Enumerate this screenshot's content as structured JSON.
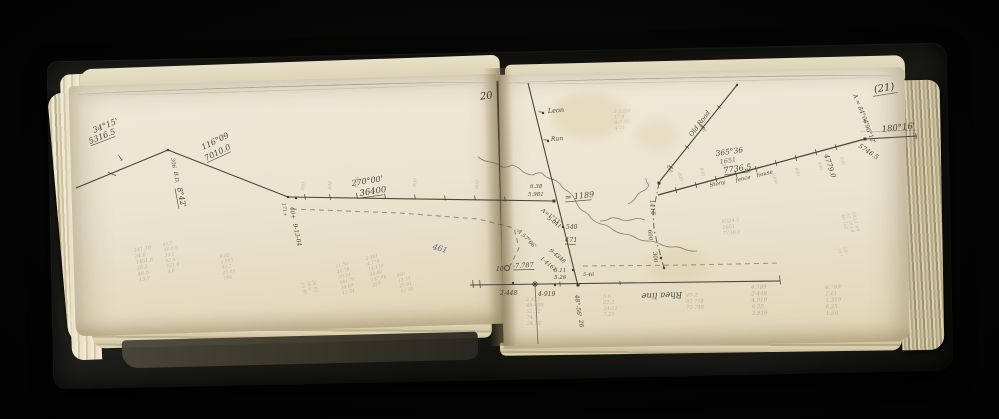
{
  "palette": {
    "background": "#050505",
    "cover": "#191a16",
    "page": "#ece4cf",
    "ink": "#3b3a33",
    "pencil": "#8d8570",
    "blue_ink": "#44517a"
  },
  "page_numbers": {
    "left": "20",
    "right": "(21)"
  },
  "diagram": {
    "lines": [
      [
        76,
        188,
        168,
        150
      ],
      [
        168,
        150,
        288,
        197
      ],
      [
        288,
        197,
        554,
        201
      ],
      [
        528,
        83,
        578,
        286
      ],
      [
        470,
        285,
        780,
        281
      ],
      [
        535,
        284,
        538,
        344,
        0.8,
        0.7
      ],
      [
        658,
        195,
        865,
        139,
        1.3
      ],
      [
        865,
        139,
        917,
        136
      ],
      [
        860,
        132,
        917,
        130,
        0.6,
        0.35
      ],
      [
        660,
        181,
        737,
        85
      ]
    ],
    "dashed": [
      {
        "pts": [
          [
            292,
            209
          ],
          [
            400,
            213
          ],
          [
            478,
            219
          ],
          [
            514,
            228
          ],
          [
            519,
            248
          ],
          [
            510,
            266
          ]
        ],
        "dash": "5 4",
        "o": 0.55
      },
      {
        "pts": [
          [
            583,
            266
          ],
          [
            690,
            265
          ],
          [
            780,
            263
          ]
        ],
        "dash": "5 4",
        "o": 0.5
      },
      {
        "pts": [
          [
            659,
            183
          ],
          [
            656,
            198
          ],
          [
            653,
            212
          ],
          [
            654,
            228
          ],
          [
            657,
            243
          ],
          [
            661,
            257
          ],
          [
            664,
            268
          ]
        ],
        "dash": "6 3 1.5 3",
        "o": 0.8
      }
    ],
    "streams": [
      {
        "pts": [
          [
            478,
            157
          ],
          [
            490,
            162
          ],
          [
            502,
            167
          ],
          [
            512,
            165
          ],
          [
            522,
            171
          ],
          [
            533,
            175
          ],
          [
            542,
            173
          ],
          [
            551,
            179
          ],
          [
            560,
            184
          ],
          [
            569,
            192
          ],
          [
            576,
            202
          ],
          [
            583,
            211
          ],
          [
            591,
            218
          ],
          [
            601,
            224
          ],
          [
            612,
            229
          ],
          [
            624,
            234
          ],
          [
            636,
            238
          ],
          [
            648,
            241
          ],
          [
            660,
            244
          ],
          [
            672,
            247
          ],
          [
            684,
            249
          ],
          [
            697,
            251
          ]
        ]
      },
      {
        "pts": [
          [
            600,
            221
          ],
          [
            611,
            218
          ],
          [
            622,
            220
          ],
          [
            634,
            219
          ],
          [
            645,
            220
          ]
        ]
      },
      {
        "pts": [
          [
            628,
            204
          ],
          [
            636,
            197
          ],
          [
            643,
            191
          ],
          [
            649,
            185
          ],
          [
            646,
            178
          ]
        ]
      }
    ],
    "points": [
      [
        168,
        150
      ],
      [
        288,
        197
      ],
      [
        296,
        198
      ],
      [
        554,
        201,
        3
      ],
      [
        563,
        227
      ],
      [
        573,
        270
      ],
      [
        578,
        285,
        3
      ],
      [
        513,
        283
      ],
      [
        535,
        284
      ],
      [
        555,
        285
      ],
      [
        659,
        183,
        3
      ],
      [
        661,
        258
      ],
      [
        664,
        268
      ],
      [
        865,
        139,
        3
      ],
      [
        737,
        85
      ],
      [
        543,
        113
      ],
      [
        548,
        141
      ]
    ],
    "circles": [
      [
        507,
        268,
        2.5
      ],
      [
        535,
        284,
        2.2
      ]
    ],
    "ticks": [
      [
        112,
        174,
        25,
        9
      ],
      [
        305,
        197,
        80,
        6
      ],
      [
        330,
        197,
        80,
        6
      ],
      [
        357,
        196,
        80,
        6
      ],
      [
        385,
        196,
        80,
        5
      ],
      [
        415,
        197,
        80,
        5
      ],
      [
        445,
        198,
        80,
        5
      ],
      [
        475,
        198,
        80,
        5
      ],
      [
        505,
        199,
        80,
        5
      ],
      [
        541,
        112,
        5,
        5
      ],
      [
        546,
        140,
        5,
        5
      ],
      [
        473,
        284,
        85,
        8
      ],
      [
        480,
        284,
        85,
        8
      ],
      [
        780,
        280,
        85,
        9
      ],
      [
        560,
        284,
        85,
        5
      ],
      [
        620,
        283,
        85,
        4
      ],
      [
        676,
        190,
        75,
        6
      ],
      [
        696,
        185,
        75,
        6
      ],
      [
        716,
        179,
        75,
        6
      ],
      [
        736,
        174,
        75,
        6
      ],
      [
        756,
        169,
        75,
        6
      ],
      [
        776,
        163,
        75,
        6
      ],
      [
        796,
        158,
        75,
        6
      ],
      [
        816,
        152,
        75,
        6
      ],
      [
        836,
        147,
        75,
        6
      ],
      [
        671,
        167,
        35,
        5
      ],
      [
        687,
        147,
        35,
        5
      ],
      [
        703,
        127,
        35,
        5
      ],
      [
        719,
        107,
        35,
        5
      ],
      [
        916,
        136,
        85,
        6
      ]
    ],
    "labels": [
      {
        "t": "34°15'",
        "x": 94,
        "y": 133,
        "r": -22,
        "s": 8
      },
      {
        "t": "5316.5",
        "x": 90,
        "y": 144,
        "r": -22,
        "s": 8,
        "u": 1
      },
      {
        "t": "↘",
        "x": 116,
        "y": 160,
        "r": 10,
        "s": 9,
        "o": 0.85
      },
      {
        "t": "306",
        "x": 171,
        "y": 158,
        "r": 82,
        "s": 5.5,
        "o": 0.85
      },
      {
        "t": "B.D.",
        "x": 174,
        "y": 172,
        "r": 82,
        "s": 5.5,
        "o": 0.85
      },
      {
        "t": "8°42'",
        "x": 177,
        "y": 188,
        "r": 78,
        "s": 7.5,
        "u": 1
      },
      {
        "t": "116°09",
        "x": 203,
        "y": 150,
        "r": -26,
        "s": 8
      },
      {
        "t": "7010.0",
        "x": 206,
        "y": 161,
        "r": -26,
        "s": 8,
        "u": 1
      },
      {
        "t": "171+",
        "x": 282,
        "y": 203,
        "r": 82,
        "s": 5,
        "o": 0.8
      },
      {
        "t": "40+",
        "x": 290,
        "y": 207,
        "r": 82,
        "s": 6
      },
      {
        "t": "9-13-04",
        "x": 293,
        "y": 224,
        "r": 78,
        "s": 6
      },
      {
        "t": "270°00'",
        "x": 352,
        "y": 186,
        "r": -9,
        "s": 8
      },
      {
        "t": "36400",
        "x": 360,
        "y": 196,
        "r": -9,
        "s": 8.5,
        "u": 1
      },
      {
        "t": "461",
        "x": 432,
        "y": 249,
        "r": 16,
        "s": 8,
        "c": "blue",
        "o": 0.85
      },
      {
        "t": "Leon",
        "x": 548,
        "y": 113,
        "r": -4,
        "s": 6.5
      },
      {
        "t": "Run",
        "x": 551,
        "y": 141,
        "r": -4,
        "s": 6
      },
      {
        "t": "6.38",
        "x": 530,
        "y": 188,
        "r": 0,
        "s": 5.5
      },
      {
        "t": "5.981",
        "x": 528,
        "y": 196,
        "r": 0,
        "s": 5.5
      },
      {
        "t": "= 1189",
        "x": 565,
        "y": 200,
        "r": -6,
        "s": 8,
        "u": 1
      },
      {
        "t": "A=1°11'",
        "x": 541,
        "y": 211,
        "r": 36,
        "s": 5.5
      },
      {
        "t": "5-041'",
        "x": 547,
        "y": 219,
        "r": 36,
        "s": 5.5
      },
      {
        "t": "-A 57°06'",
        "x": 516,
        "y": 230,
        "r": 46,
        "s": 5.5
      },
      {
        "t": "540",
        "x": 566,
        "y": 229,
        "r": 0,
        "s": 6
      },
      {
        "t": "471",
        "x": 565,
        "y": 242,
        "r": 0,
        "s": 6.5,
        "u": 1
      },
      {
        "t": "9-4348",
        "x": 549,
        "y": 251,
        "r": 40,
        "s": 5.5
      },
      {
        "t": "1-4161",
        "x": 540,
        "y": 259,
        "r": 40,
        "s": 5.5
      },
      {
        "t": "6.11",
        "x": 554,
        "y": 272,
        "r": 0,
        "s": 5.5
      },
      {
        "t": "5.26",
        "x": 554,
        "y": 279,
        "r": 0,
        "s": 5.5
      },
      {
        "t": "5-46",
        "x": 583,
        "y": 276,
        "r": 0,
        "s": 5,
        "o": 0.85
      },
      {
        "t": "10",
        "x": 496,
        "y": 271,
        "r": 0,
        "s": 6
      },
      {
        "t": "-7.787",
        "x": 513,
        "y": 268,
        "r": -3,
        "s": 6.5,
        "u": 1
      },
      {
        "t": "2-448",
        "x": 500,
        "y": 295,
        "r": 0,
        "s": 6
      },
      {
        "t": "4-919",
        "x": 538,
        "y": 296,
        "r": 0,
        "s": 6
      },
      {
        "t": "48°-56'",
        "x": 575,
        "y": 295,
        "r": 84,
        "s": 6
      },
      {
        "t": "26",
        "x": 579,
        "y": 320,
        "r": 84,
        "s": 6
      },
      {
        "t": "Rhea line",
        "x": 682,
        "y": 292,
        "r": 178,
        "s": 8.5
      },
      {
        "t": "365°36",
        "x": 716,
        "y": 156,
        "r": -8,
        "s": 7.5
      },
      {
        "t": "1651",
        "x": 720,
        "y": 164,
        "r": -8,
        "s": 6.5,
        "o": 0.7
      },
      {
        "t": "7736.5",
        "x": 724,
        "y": 173,
        "r": -8,
        "s": 8,
        "u": 1
      },
      {
        "t": "Stony",
        "x": 710,
        "y": 187,
        "r": -13,
        "s": 5.5
      },
      {
        "t": "fence",
        "x": 736,
        "y": 182,
        "r": -13,
        "s": 5.5
      },
      {
        "t": "house",
        "x": 757,
        "y": 177,
        "r": -13,
        "s": 5.5
      },
      {
        "t": "4779.0",
        "x": 824,
        "y": 155,
        "r": 72,
        "s": 7
      },
      {
        "t": "Old Road",
        "x": 692,
        "y": 137,
        "r": -53,
        "s": 6.5
      },
      {
        "t": "1416",
        "x": 650,
        "y": 200,
        "r": 84,
        "s": 6
      },
      {
        "t": "600",
        "x": 648,
        "y": 230,
        "r": 84,
        "s": 5.5
      },
      {
        "t": "300",
        "x": 653,
        "y": 252,
        "r": 84,
        "s": 5.5
      },
      {
        "t": "400",
        "x": 666,
        "y": 166,
        "r": 58,
        "s": 4.5,
        "o": 0.6
      },
      {
        "t": "800",
        "x": 699,
        "y": 125,
        "r": 58,
        "s": 4.5,
        "o": 0.6
      },
      {
        "t": "A = 84°04'",
        "x": 853,
        "y": 95,
        "r": 68,
        "s": 6
      },
      {
        "t": "+ 96°12'",
        "x": 862,
        "y": 119,
        "r": 68,
        "s": 6
      },
      {
        "t": "180°16'",
        "x": 882,
        "y": 132,
        "r": -6,
        "s": 8.5
      },
      {
        "t": "5746.5",
        "x": 858,
        "y": 147,
        "r": 34,
        "s": 6.5
      },
      {
        "t": "300",
        "x": 304,
        "y": 191,
        "r": -85,
        "s": 4.5,
        "c": "pencil",
        "o": 0.5
      },
      {
        "t": "500",
        "x": 331,
        "y": 190,
        "r": -85,
        "s": 4.5,
        "c": "pencil",
        "o": 0.5
      },
      {
        "t": "1000",
        "x": 358,
        "y": 188,
        "r": -85,
        "s": 4.5,
        "c": "pencil",
        "o": 0.5
      },
      {
        "t": "800",
        "x": 416,
        "y": 187,
        "r": -85,
        "s": 4.5,
        "c": "pencil",
        "o": 0.45
      },
      {
        "t": "600",
        "x": 478,
        "y": 189,
        "r": -85,
        "s": 4.5,
        "c": "pencil",
        "o": 0.45
      },
      {
        "t": "600",
        "x": 678,
        "y": 173,
        "r": 75,
        "s": 4.5,
        "c": "pencil",
        "o": 0.55
      },
      {
        "t": "800",
        "x": 700,
        "y": 168,
        "r": 75,
        "s": 4.5,
        "c": "pencil",
        "o": 0.5
      },
      {
        "t": "400",
        "x": 722,
        "y": 164,
        "r": 75,
        "s": 4.5,
        "c": "pencil",
        "o": 0.5
      },
      {
        "t": "1000",
        "x": 772,
        "y": 173,
        "r": 75,
        "s": 4.5,
        "c": "pencil",
        "o": 0.5
      },
      {
        "t": "600",
        "x": 795,
        "y": 168,
        "r": 75,
        "s": 4.5,
        "c": "pencil",
        "o": 0.5
      },
      {
        "t": "400",
        "x": 818,
        "y": 162,
        "r": 75,
        "s": 4.5,
        "c": "pencil",
        "o": 0.5
      },
      {
        "t": "100",
        "x": 840,
        "y": 157,
        "r": 75,
        "s": 4.5,
        "c": "pencil",
        "o": 0.5
      }
    ],
    "pencil_blocks": [
      {
        "x": 134,
        "y": 252,
        "r": -10,
        "s": 5,
        "o": 0.5,
        "lh": 6,
        "lines": [
          "141.70",
          "34.6",
          "1451.6",
          "28.2",
          "46.5",
          "13-7"
        ]
      },
      {
        "x": 163,
        "y": 246,
        "r": -10,
        "s": 4.5,
        "o": 0.45,
        "lh": 5.5,
        "lines": [
          "41.7",
          "16-0.5",
          "34-2",
          "62.4",
          "121.6",
          "4 8"
        ]
      },
      {
        "x": 220,
        "y": 258,
        "r": -10,
        "s": 4.5,
        "o": 0.45,
        "lh": 5.5,
        "lines": [
          "4.82",
          "2.905",
          "48.2",
          "29.05",
          "184"
        ]
      },
      {
        "x": 336,
        "y": 268,
        "r": -14,
        "s": 4.5,
        "o": 0.5,
        "lh": 5.5,
        "lines": [
          "11.70",
          "44.78",
          "20 54",
          "141 70",
          "34 60",
          "12 54"
        ]
      },
      {
        "x": 366,
        "y": 260,
        "r": -14,
        "s": 4.5,
        "o": 0.5,
        "lh": 5.5,
        "lines": [
          "2.361",
          "4.778",
          "14.170",
          "34.60",
          "147.96",
          "225"
        ]
      },
      {
        "x": 397,
        "y": 277,
        "r": -14,
        "s": 4.5,
        "o": 0.45,
        "lh": 5.5,
        "lines": [
          "460",
          "13 24",
          "25 91",
          "62 48"
        ]
      },
      {
        "x": 312,
        "y": 280,
        "r": 76,
        "s": 4.5,
        "o": 0.45,
        "lh": 5.5,
        "lines": [
          "26-05",
          "36½",
          "18 46"
        ]
      },
      {
        "x": 614,
        "y": 113,
        "r": -4,
        "s": 4.5,
        "o": 0.38,
        "lh": 5.5,
        "lines": [
          "3 3.254",
          "17 4",
          "4-7 32",
          "4 21"
        ]
      },
      {
        "x": 722,
        "y": 223,
        "r": -6,
        "s": 5,
        "o": 0.5,
        "lh": 6,
        "lines": [
          "6524.5",
          "1651",
          "7736.1"
        ]
      },
      {
        "x": 852,
        "y": 212,
        "r": 76,
        "s": 4.5,
        "o": 0.42,
        "lh": 5.5,
        "lines": [
          "103.1 64",
          "52 103.8",
          "46 182"
        ]
      },
      {
        "x": 843,
        "y": 247,
        "r": 76,
        "s": 4.5,
        "o": 0.4,
        "lh": 5.5,
        "lines": [
          "107",
          "157"
        ]
      },
      {
        "x": 526,
        "y": 301,
        "r": -2,
        "s": 5,
        "o": 0.5,
        "lh": 6,
        "lines": [
          "2.473",
          "48-498",
          "52.52",
          "74.5",
          "24.52"
        ]
      },
      {
        "x": 603,
        "y": 298,
        "r": -2,
        "s": 5,
        "o": 0.48,
        "lh": 6,
        "lines": [
          "5.6",
          "27-3",
          "24-52",
          "7.25"
        ]
      },
      {
        "x": 686,
        "y": 297,
        "r": -2,
        "s": 5,
        "o": 0.48,
        "lh": 6,
        "lines": [
          "47-2'",
          "82-758",
          "72-748"
        ]
      },
      {
        "x": 751,
        "y": 289,
        "r": -2,
        "s": 5.5,
        "o": 0.55,
        "lh": 6.5,
        "lines": [
          "4.789",
          "2-448",
          "4.919",
          "6.25",
          "2.919"
        ]
      },
      {
        "x": 825,
        "y": 289,
        "r": -2,
        "s": 5.5,
        "o": 0.5,
        "lh": 6.5,
        "lines": [
          "4.789",
          "2.61",
          "1.319",
          "6.25",
          "1.50"
        ]
      }
    ]
  }
}
